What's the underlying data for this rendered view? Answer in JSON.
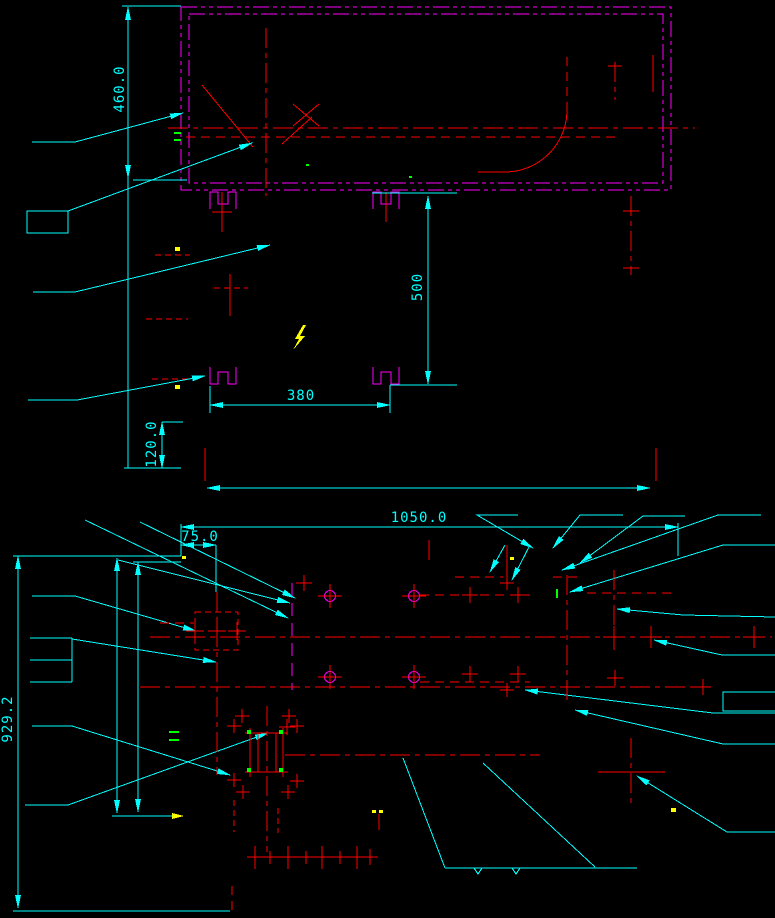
{
  "drawing": {
    "title": "cad-foundation-detail-drawing",
    "views": {
      "top": "equipment-enclosure-detail",
      "bottom": "foundation-plan-detail"
    }
  },
  "dimensions": {
    "d460": "460.0",
    "d120": "120.0",
    "d380": "380",
    "d500": "500",
    "d1050": "1050.0",
    "d75": "75.0",
    "d929": "929.2"
  },
  "colors": {
    "dimension_lines": "#00ffff",
    "geometry": "#ff0000",
    "phantom_border": "#ff00ff",
    "highlight": "#ffff00",
    "marks": "#00ff00",
    "background": "#000000"
  },
  "icons": {
    "lightning": "lightning-bolt-icon",
    "arrow": "dimension-arrow-icon"
  }
}
